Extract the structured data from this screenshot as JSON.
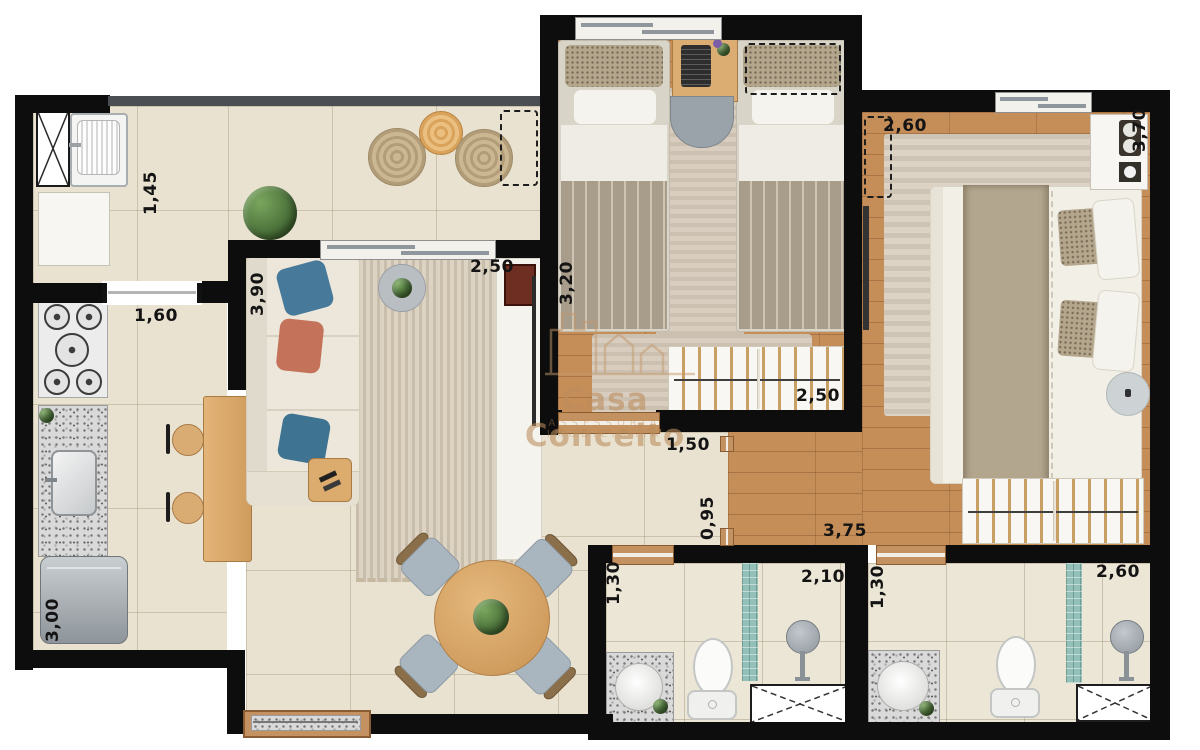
{
  "watermark": {
    "brand": "Casa Conceito",
    "tagline": "ASSESSORIA IMOBILIÁRIA"
  },
  "dimensions": {
    "terrace_depth": "1,45",
    "kitchen_opening": "1,60",
    "living_length": "3,90",
    "living_window": "2,50",
    "bedroom2_length": "3,20",
    "master_head_wall": "2,60",
    "master_length": "3,70",
    "bedroom2_closet": "2,50",
    "hall_opening": "1,50",
    "hall_passage": "0,95",
    "master_width": "3,75",
    "bath1_depth": "1,30",
    "bath1_width": "2,10",
    "bath2_depth": "1,30",
    "bath2_width": "2,60",
    "kitchen_depth": "3,00"
  },
  "palette": {
    "wall": "#0d0d0d",
    "tile_floor": "#e9e2d1",
    "wood_floor": "#c58d58",
    "mosaic_teal": "#93c0b8",
    "pillow_blue": "#47799b",
    "pillow_terracotta": "#c4725a",
    "watermark_tan": "#ba8c5c"
  }
}
